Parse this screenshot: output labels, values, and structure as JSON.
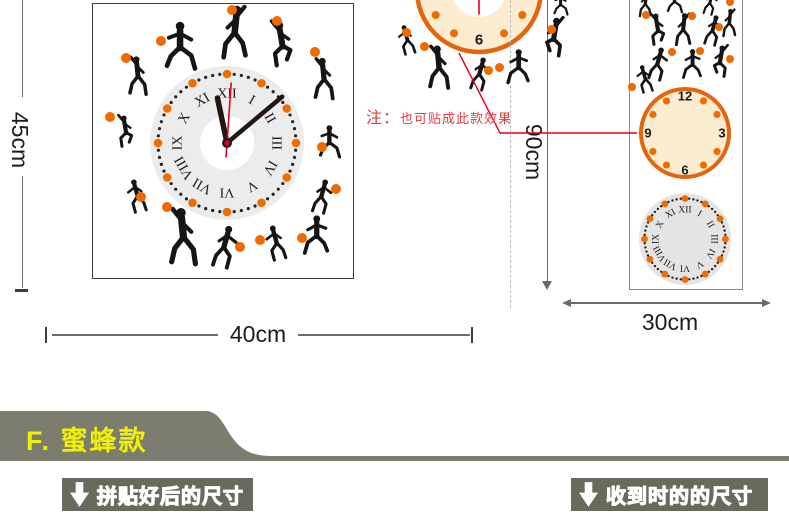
{
  "dimension_labels": {
    "height_main": "45cm",
    "width_main": "40cm",
    "height_variant": "90cm",
    "width_packed": "30cm"
  },
  "note": {
    "prefix": "注：",
    "text": "也可贴成此款效果"
  },
  "clocks": {
    "main": {
      "style": "roman",
      "numerals": [
        "XII",
        "I",
        "II",
        "III",
        "IV",
        "V",
        "VI",
        "VII",
        "VIII",
        "IX",
        "X",
        "XI"
      ],
      "face_color": "#ececec",
      "hub_color": "#ffffff",
      "hour_dot_color": "#ed6d00",
      "minute_dot_color": "#232323",
      "hands": {
        "hour_angle_deg": -12,
        "minute_angle_deg": 50,
        "second_angle_deg": 4,
        "hand_color": "#241612",
        "second_color": "#e60013"
      }
    },
    "variant_top": {
      "style": "arabic",
      "numerals": [
        "12",
        "3",
        "6",
        "9"
      ],
      "face_color": "#fcecd0",
      "ring_color": "#e4650f",
      "hub_color": "#ffffff",
      "dot_color": "#ed6d00",
      "hands": {
        "second_angle_deg": 180,
        "second_color": "#e60013"
      }
    },
    "packed_arabic": {
      "style": "arabic",
      "numerals": [
        "12",
        "3",
        "6",
        "9"
      ],
      "face_color": "#fcecd0",
      "ring_color": "#e4650f",
      "dot_color": "#ed6d00"
    },
    "packed_roman": {
      "style": "roman",
      "numerals": [
        "XII",
        "I",
        "II",
        "III",
        "IV",
        "V",
        "VI",
        "VII",
        "VIII",
        "IX",
        "X",
        "XI"
      ],
      "face_color": "#e4e4e4",
      "hour_dot_color": "#ed6d00",
      "minute_dot_color": "#232323"
    }
  },
  "section_banner": {
    "label": "F. 蜜蜂款"
  },
  "captions": {
    "assembled": "拼贴好后的尺寸",
    "received": "收到时的的尺寸"
  },
  "colors": {
    "accent_orange": "#ec6a00",
    "callout_red": "#e60013",
    "note_red": "#e43a42",
    "band_olive": "#7c7d6f",
    "caption_bg": "#696a5c",
    "banner_text_yellow": "#f1f000"
  }
}
